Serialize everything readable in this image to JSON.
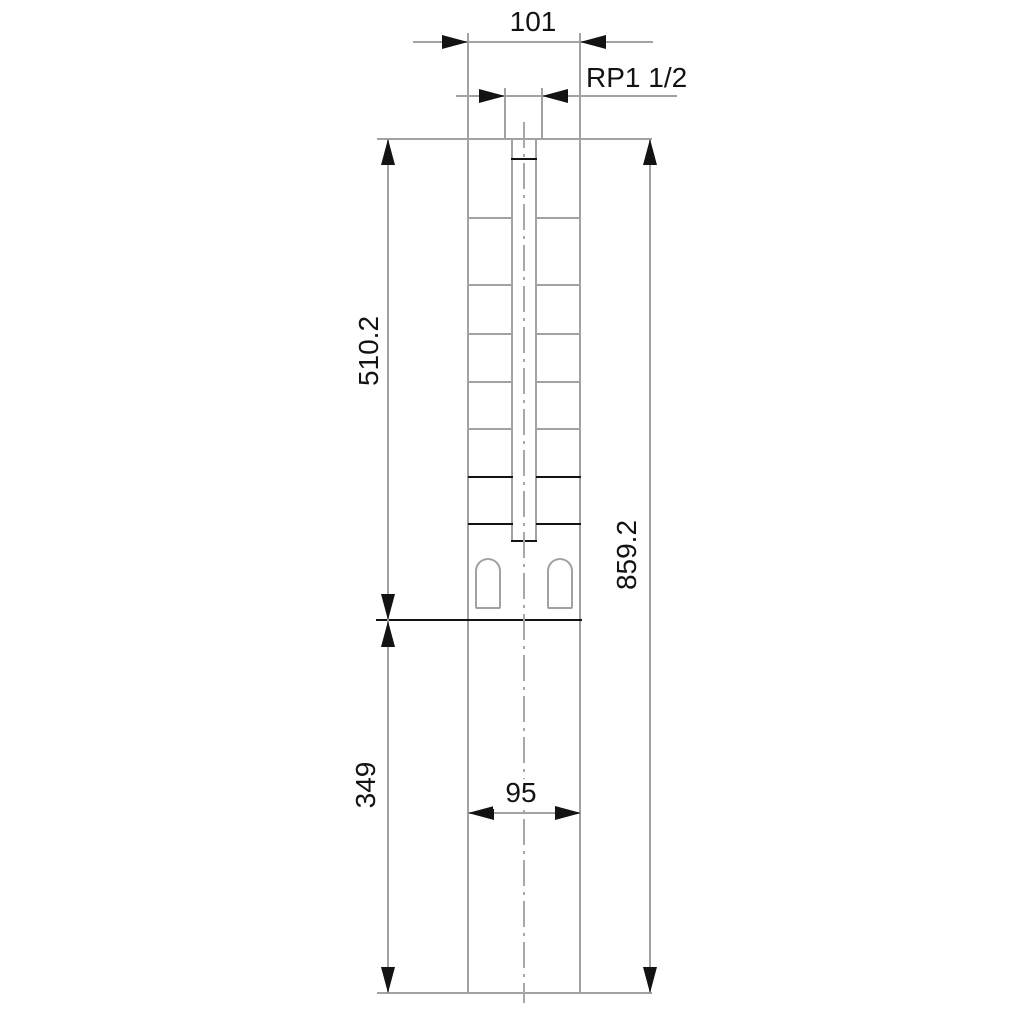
{
  "drawing": {
    "type": "technical-dimension-drawing",
    "subject": "submersible pump outline with dimensions",
    "units_note": "",
    "dimensions": {
      "top_width": "101",
      "thread": "RP1 1/2",
      "upper_section_length": "510.2",
      "overall_length": "859.2",
      "lower_section_length": "349",
      "lower_width": "95"
    },
    "colors": {
      "outline_gray": "#a2a2a2",
      "dimension_black": "#131313",
      "background": "#ffffff"
    }
  }
}
